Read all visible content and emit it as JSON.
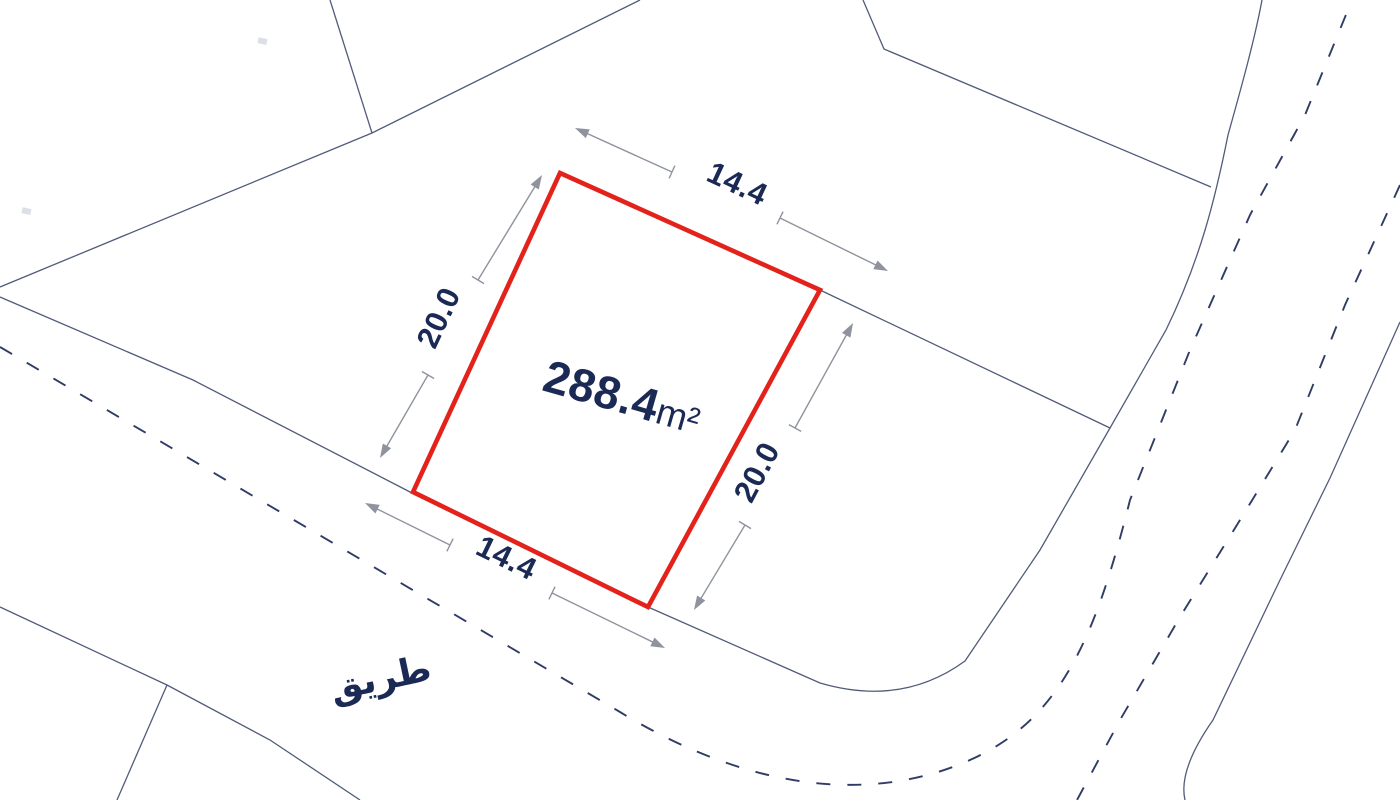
{
  "map": {
    "parcel": {
      "area_value": "288.4",
      "area_unit": "m²",
      "dimensions": {
        "top": "14.4",
        "right": "20.0",
        "bottom": "14.4",
        "left": "20.0"
      }
    },
    "road_label": "طريق",
    "colors": {
      "parcel_outline_red": "#e3231b",
      "label_navy": "#1b2a55",
      "boundary_line": "#515c7a",
      "road_dashed": "#2f3c66",
      "dimension_gray": "#8e939e",
      "background": "#ffffff"
    }
  }
}
